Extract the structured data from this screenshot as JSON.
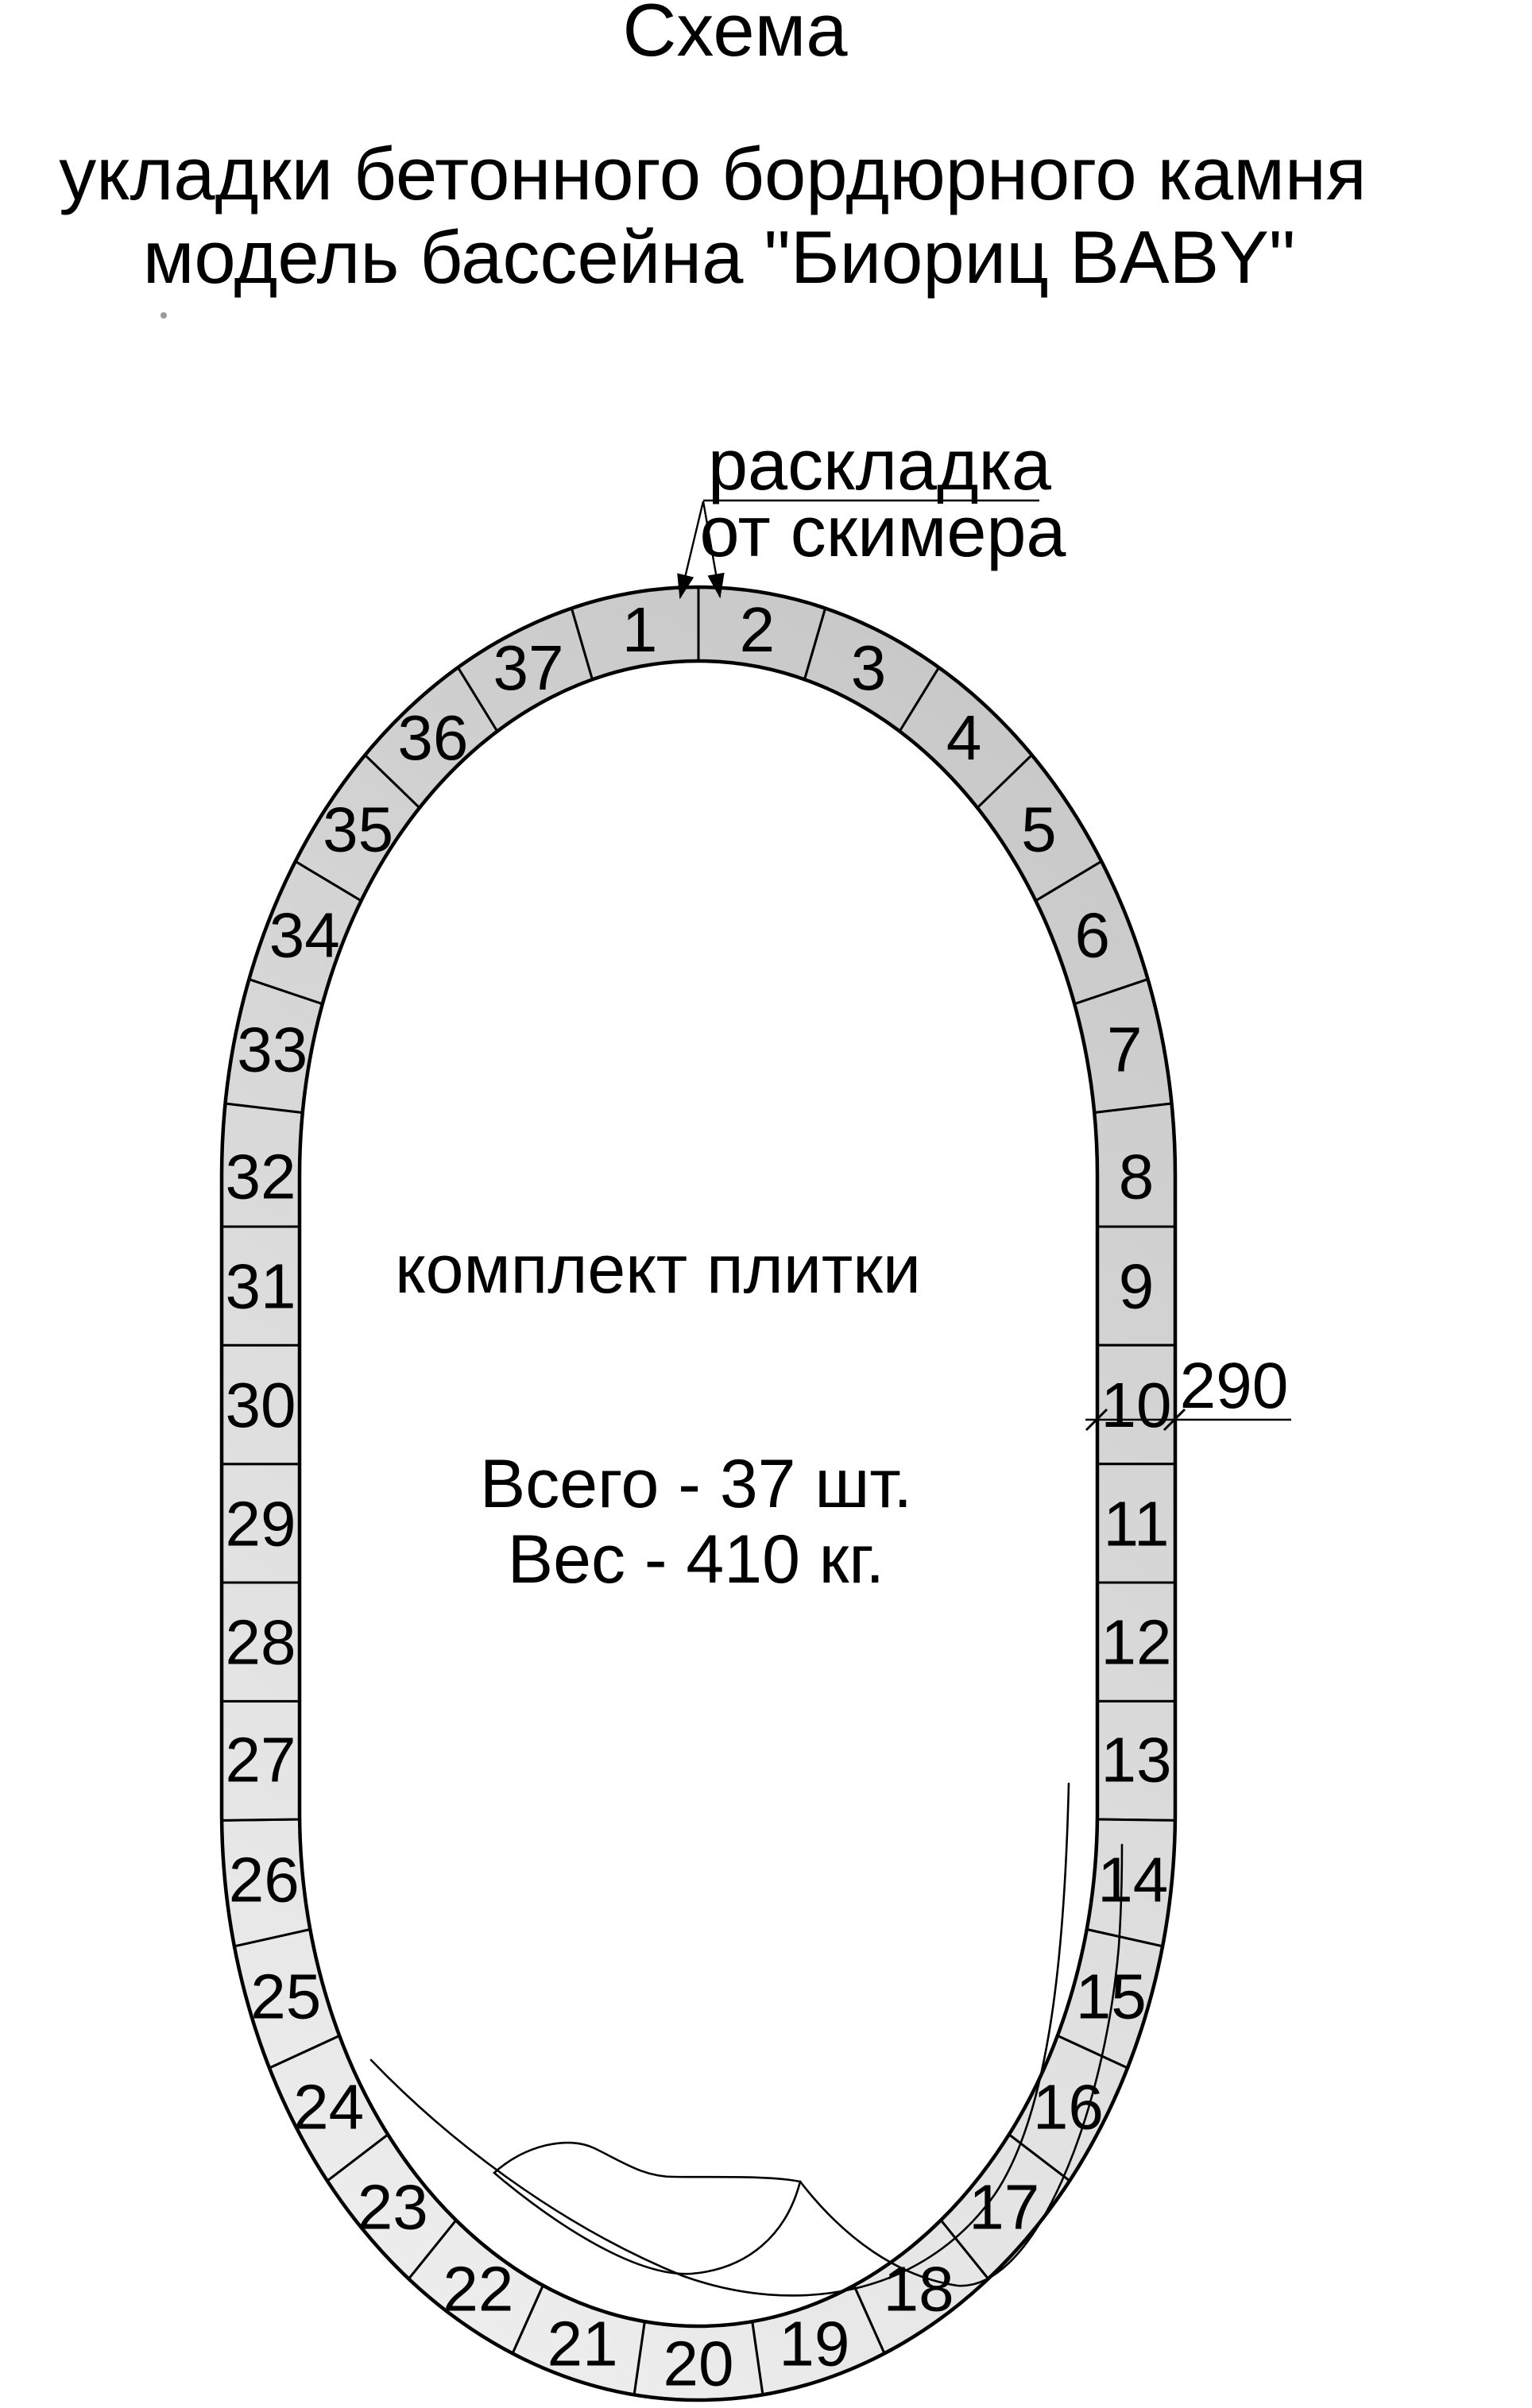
{
  "title": "Схема",
  "subtitle": {
    "line1": "укладки бетонного бордюрного камня",
    "line2": "модель бассейна \"Биориц BABY\""
  },
  "annotation": {
    "line1": "раскладка",
    "line2": "от скимера"
  },
  "center": {
    "label": "комплект плитки",
    "total": "Всего - 37 шт.",
    "weight": "Вес - 410 кг."
  },
  "dimension": {
    "value": "290"
  },
  "ring": {
    "segment_count": 37,
    "numbers": [
      1,
      2,
      3,
      4,
      5,
      6,
      7,
      8,
      9,
      10,
      11,
      12,
      13,
      14,
      15,
      16,
      17,
      18,
      19,
      20,
      21,
      22,
      23,
      24,
      25,
      26,
      27,
      28,
      29,
      30,
      31,
      32,
      33,
      34,
      35,
      36,
      37
    ],
    "fill_dark": "#c7c7c7",
    "fill_light": "#ededed",
    "stroke": "#000000",
    "number_color": "#000000"
  }
}
